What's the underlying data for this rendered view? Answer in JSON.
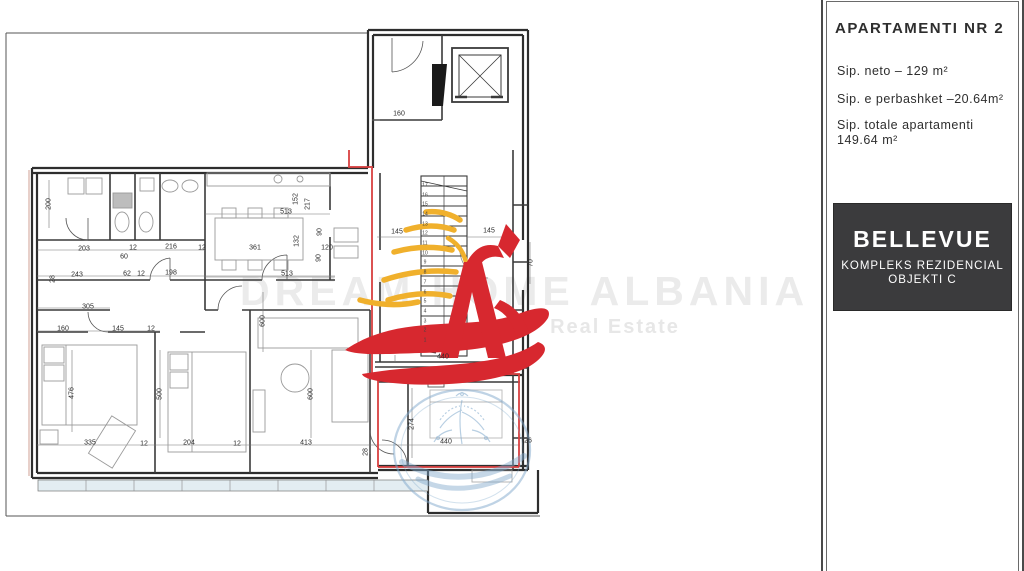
{
  "panel": {
    "title": "APARTAMENTI NR 2",
    "area_neto": "Sip. neto –   129 m²",
    "area_common": "Sip. e perbashket –20.64m²",
    "area_total_label": "Sip. totale apartamenti",
    "area_total_value": "149.64 m²",
    "brand": "BELLEVUE",
    "brand_sub1": "KOMPLEKS REZIDENCIAL",
    "brand_sub2": "OBJEKTI C",
    "brand_bg": "#3b3b3d"
  },
  "watermark": {
    "line1": "DREAM HOME ALBANIA",
    "line2": "Real Estate"
  },
  "colors": {
    "highlight_red": "#d84040",
    "logo_red": "#d7282f",
    "logo_yellow": "#f0b02c",
    "stamp_blue": "#7fa8cc",
    "wall": "#2e2e2e"
  },
  "plan": {
    "dimensions": [
      {
        "t": "160",
        "x": 399,
        "y": 114,
        "r": 0
      },
      {
        "t": "145",
        "x": 397,
        "y": 232,
        "r": 0
      },
      {
        "t": "145",
        "x": 489,
        "y": 231,
        "r": 0
      },
      {
        "t": "513",
        "x": 286,
        "y": 212,
        "r": 0
      },
      {
        "t": "513",
        "x": 287,
        "y": 274,
        "r": 0
      },
      {
        "t": "361",
        "x": 255,
        "y": 248,
        "r": 0
      },
      {
        "t": "120",
        "x": 327,
        "y": 248,
        "r": 0
      },
      {
        "t": "203",
        "x": 84,
        "y": 249,
        "r": 0
      },
      {
        "t": "12",
        "x": 133,
        "y": 248,
        "r": 0
      },
      {
        "t": "216",
        "x": 171,
        "y": 247,
        "r": 0
      },
      {
        "t": "12",
        "x": 202,
        "y": 248,
        "r": 0
      },
      {
        "t": "60",
        "x": 124,
        "y": 257,
        "r": 0
      },
      {
        "t": "243",
        "x": 77,
        "y": 275,
        "r": 0
      },
      {
        "t": "62",
        "x": 127,
        "y": 274,
        "r": 0
      },
      {
        "t": "12",
        "x": 141,
        "y": 274,
        "r": 0
      },
      {
        "t": "198",
        "x": 171,
        "y": 273,
        "r": 0
      },
      {
        "t": "305",
        "x": 88,
        "y": 307,
        "r": 0
      },
      {
        "t": "160",
        "x": 63,
        "y": 329,
        "r": 0
      },
      {
        "t": "145",
        "x": 118,
        "y": 329,
        "r": 0
      },
      {
        "t": "12",
        "x": 151,
        "y": 329,
        "r": 0
      },
      {
        "t": "335",
        "x": 90,
        "y": 443,
        "r": 0
      },
      {
        "t": "12",
        "x": 144,
        "y": 444,
        "r": 0
      },
      {
        "t": "204",
        "x": 189,
        "y": 443,
        "r": 0
      },
      {
        "t": "12",
        "x": 237,
        "y": 444,
        "r": 0
      },
      {
        "t": "413",
        "x": 306,
        "y": 443,
        "r": 0
      },
      {
        "t": "440",
        "x": 443,
        "y": 357,
        "r": 0
      },
      {
        "t": "440",
        "x": 446,
        "y": 442,
        "r": 0
      },
      {
        "t": "26",
        "x": 528,
        "y": 441,
        "r": 0
      },
      {
        "t": "200",
        "x": 49,
        "y": 204,
        "r": 90
      },
      {
        "t": "28",
        "x": 53,
        "y": 279,
        "r": 90
      },
      {
        "t": "152",
        "x": 296,
        "y": 199,
        "r": 90
      },
      {
        "t": "217",
        "x": 308,
        "y": 204,
        "r": 90
      },
      {
        "t": "132",
        "x": 297,
        "y": 241,
        "r": 90
      },
      {
        "t": "90",
        "x": 320,
        "y": 232,
        "r": 90
      },
      {
        "t": "90",
        "x": 319,
        "y": 258,
        "r": 90
      },
      {
        "t": "476",
        "x": 72,
        "y": 393,
        "r": 90
      },
      {
        "t": "500",
        "x": 160,
        "y": 394,
        "r": 90
      },
      {
        "t": "600",
        "x": 263,
        "y": 321,
        "r": 90
      },
      {
        "t": "600",
        "x": 311,
        "y": 394,
        "r": 90
      },
      {
        "t": "274",
        "x": 412,
        "y": 424,
        "r": 90
      },
      {
        "t": "70",
        "x": 531,
        "y": 263,
        "r": 90
      },
      {
        "t": "28",
        "x": 366,
        "y": 452,
        "r": 90
      }
    ],
    "stair_numbers": [
      "1",
      "2",
      "3",
      "4",
      "5",
      "6",
      "7",
      "8",
      "9",
      "10",
      "11",
      "12",
      "13",
      "14",
      "15",
      "16",
      "17"
    ]
  }
}
